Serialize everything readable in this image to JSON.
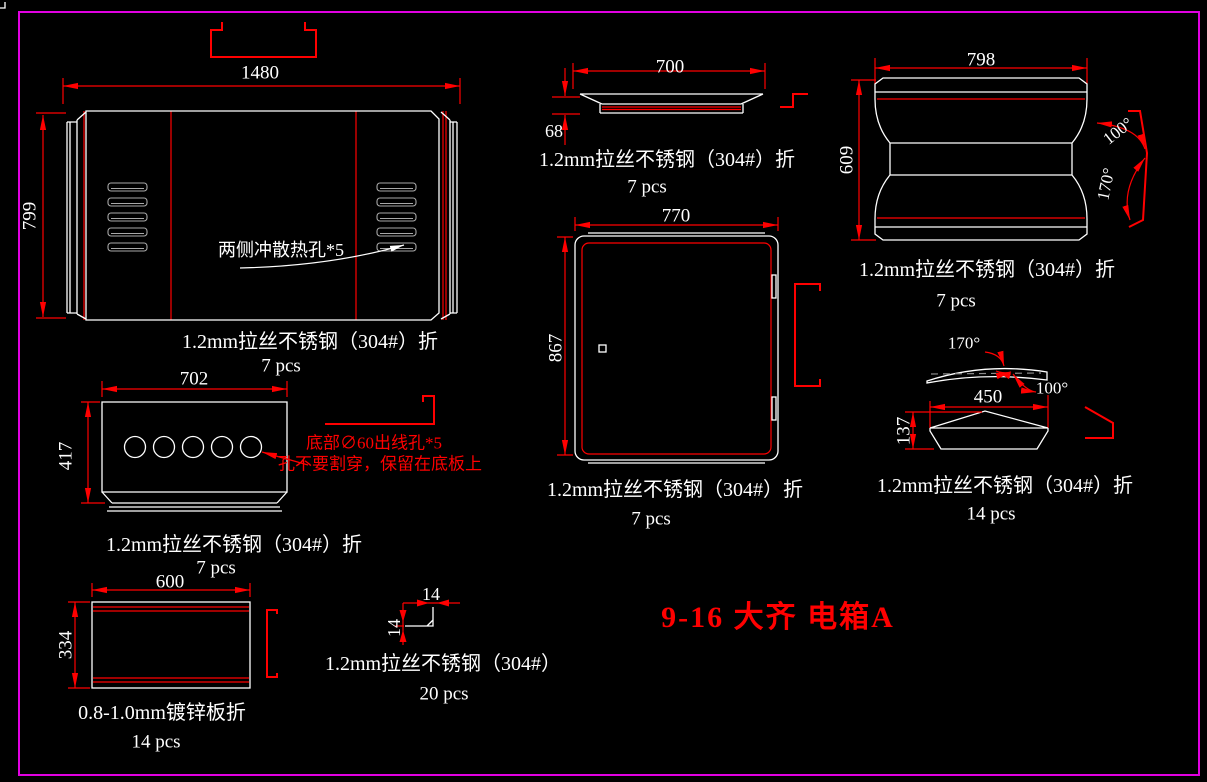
{
  "drawing_title": "9-16 大齐 电箱A",
  "colors": {
    "background": "#000000",
    "line": "#ffffff",
    "dimension": "#ff0000",
    "border": "#e100e1",
    "vent_slot": "#a8a8a8"
  },
  "parts": {
    "front_panel": {
      "dim_width": "1480",
      "dim_height": "799",
      "note": "两侧冲散热孔*5",
      "material": "1.2mm拉丝不锈钢（304#）折",
      "qty": "7 pcs"
    },
    "top_lid": {
      "dim_width": "700",
      "dim_height": "68",
      "material": "1.2mm拉丝不锈钢（304#）折",
      "qty": "7 pcs"
    },
    "side_panel": {
      "dim_width": "798",
      "dim_height": "609",
      "angle_top": "100°",
      "angle_bottom": "170°",
      "material": "1.2mm拉丝不锈钢（304#）折",
      "qty": "7 pcs"
    },
    "door": {
      "dim_width": "770",
      "dim_height": "867",
      "material": "1.2mm拉丝不锈钢（304#）折",
      "qty": "7 pcs"
    },
    "bottom_panel": {
      "dim_width": "702",
      "dim_height": "417",
      "note_line1": "底部∅60出线孔*5",
      "note_line2": "孔不要割穿，保留在底板上",
      "material": "1.2mm拉丝不锈钢（304#）折",
      "qty": "7 pcs"
    },
    "cap_panel": {
      "dim_width": "450",
      "dim_height": "137",
      "angle_top": "170°",
      "angle_side": "100°",
      "material": "1.2mm拉丝不锈钢（304#）折",
      "qty": "14 pcs"
    },
    "inner_box": {
      "dim_width": "600",
      "dim_height": "334",
      "material": "0.8-1.0mm镀锌板折",
      "qty": "14 pcs"
    },
    "corner_bracket": {
      "dim_width": "14",
      "dim_height": "14",
      "material": "1.2mm拉丝不锈钢（304#）",
      "qty": "20 pcs"
    }
  }
}
